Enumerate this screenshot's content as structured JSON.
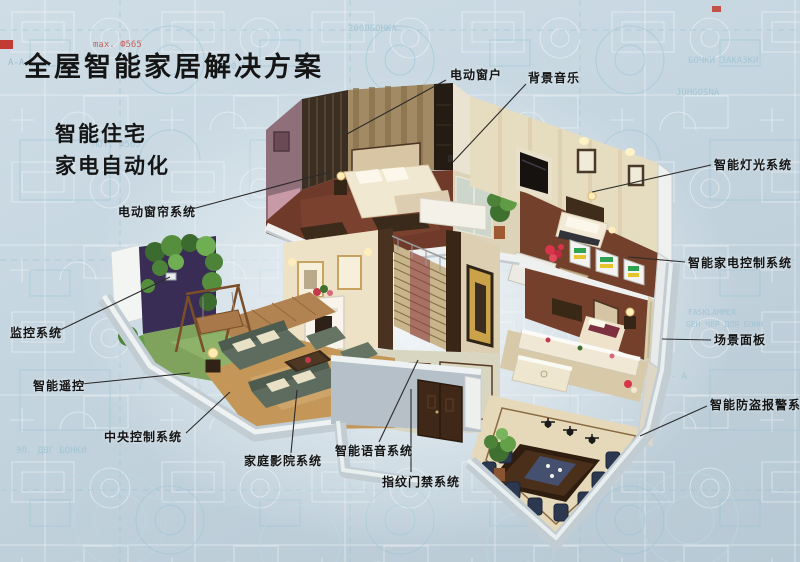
{
  "header": {
    "title": "全屋智能家居解决方案",
    "subtitle1": "智能住宅",
    "subtitle2": "家电自动化"
  },
  "callouts": [
    {
      "id": "electric-window",
      "text": "电动窗户",
      "tx": 450,
      "ty": 66,
      "x1": 446,
      "y1": 80,
      "x2": 347,
      "y2": 134
    },
    {
      "id": "background-music",
      "text": "背景音乐",
      "tx": 528,
      "ty": 69,
      "x1": 526,
      "y1": 84,
      "x2": 453,
      "y2": 162
    },
    {
      "id": "smart-lighting-system",
      "text": "智能灯光系统",
      "tx": 714,
      "ty": 156,
      "x1": 711,
      "y1": 165,
      "x2": 592,
      "y2": 192
    },
    {
      "id": "smart-appliance-control",
      "text": "智能家电控制系统",
      "tx": 688,
      "ty": 254,
      "x1": 685,
      "y1": 262,
      "x2": 628,
      "y2": 257
    },
    {
      "id": "scene-panel",
      "text": "场景面板",
      "tx": 714,
      "ty": 331,
      "x1": 711,
      "y1": 340,
      "x2": 662,
      "y2": 339
    },
    {
      "id": "smart-burglar-alarm",
      "text": "智能防盗报警系统",
      "tx": 710,
      "ty": 396,
      "x1": 707,
      "y1": 406,
      "x2": 640,
      "y2": 436
    },
    {
      "id": "monitoring-system",
      "text": "监控系统",
      "tx": 10,
      "ty": 324,
      "x1": 58,
      "y1": 331,
      "x2": 170,
      "y2": 277
    },
    {
      "id": "smart-remote",
      "text": "智能遥控",
      "tx": 33,
      "ty": 377,
      "x1": 81,
      "y1": 384,
      "x2": 190,
      "y2": 373
    },
    {
      "id": "central-control-system",
      "text": "中央控制系统",
      "tx": 104,
      "ty": 428,
      "x1": 186,
      "y1": 433,
      "x2": 230,
      "y2": 392
    },
    {
      "id": "home-theater-system",
      "text": "家庭影院系统",
      "tx": 244,
      "ty": 452,
      "x1": 291,
      "y1": 453,
      "x2": 297,
      "y2": 390
    },
    {
      "id": "smart-voice-system",
      "text": "智能语音系统",
      "tx": 335,
      "ty": 442,
      "x1": 379,
      "y1": 442,
      "x2": 418,
      "y2": 360
    },
    {
      "id": "fingerprint-access",
      "text": "指纹门禁系统",
      "tx": 382,
      "ty": 473,
      "x1": 411,
      "y1": 472,
      "x2": 411,
      "y2": 389
    },
    {
      "id": "electric-curtain-system",
      "text": "电动窗帘系统",
      "tx": 118,
      "ty": 203,
      "x1": 192,
      "y1": 209,
      "x2": 330,
      "y2": 172
    }
  ],
  "background_texts": [
    {
      "t": "A-A",
      "x": 8,
      "y": 58,
      "s": 9,
      "c": "#8fb9c9"
    },
    {
      "t": "max. Ф565",
      "x": 93,
      "y": 40,
      "s": 9,
      "c": "#c25248"
    },
    {
      "t": "200-FA5",
      "x": 220,
      "y": 62,
      "s": 9,
      "c": "#9cc4d2"
    },
    {
      "t": "200ЛБОНКА",
      "x": 348,
      "y": 24,
      "s": 9,
      "c": "#9cc4d2"
    },
    {
      "t": "min. 820",
      "x": 342,
      "y": 112,
      "s": 10,
      "c": "#9cc4d2"
    },
    {
      "t": "ПОТ. Ф565",
      "x": 92,
      "y": 140,
      "s": 9,
      "c": "#9cc4d2"
    },
    {
      "t": "JUHGOSNA",
      "x": 676,
      "y": 88,
      "s": 9,
      "c": "#9cc4d2"
    },
    {
      "t": "БОЧКИ ЗАКАЗКИ",
      "x": 688,
      "y": 56,
      "s": 9,
      "c": "#9cc4d2"
    },
    {
      "t": "FASKLAMMER",
      "x": 688,
      "y": 308,
      "s": 8,
      "c": "#9cc4d2"
    },
    {
      "t": "GEH ЧЕР ДЛЯ БОНН",
      "x": 686,
      "y": 320,
      "s": 8,
      "c": "#9cc4d2"
    },
    {
      "t": "A - A",
      "x": 660,
      "y": 372,
      "s": 9,
      "c": "#9cc4d2"
    },
    {
      "t": "ЭЛ. ДВГ БОНКИ",
      "x": 16,
      "y": 446,
      "s": 9,
      "c": "#9cc4d2"
    }
  ],
  "colors": {
    "background": "#c6d6e0",
    "blueprint_line": "#9cc4d2",
    "leader_line": "#2b2b2b",
    "label_text": "#141414",
    "title_text": "#151515",
    "red_accent": "#c23c34"
  }
}
